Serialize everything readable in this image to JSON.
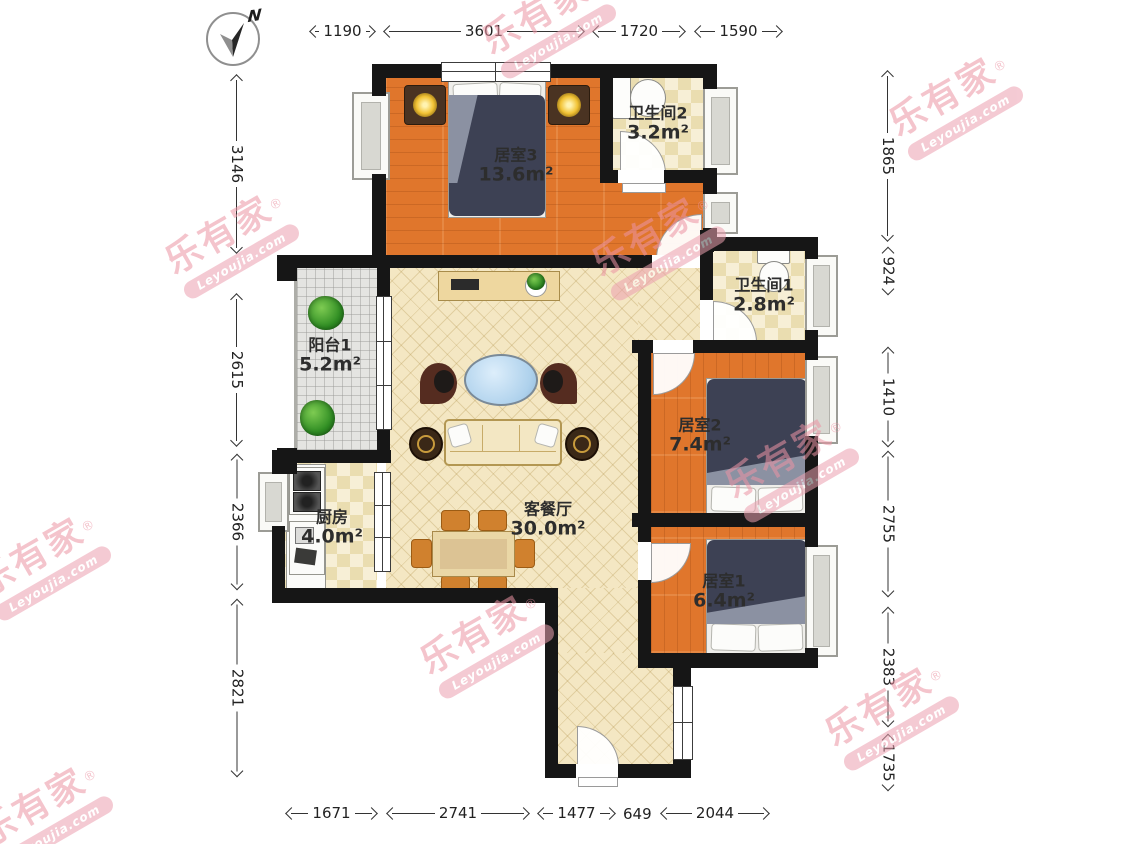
{
  "compass": {
    "north_label": "N"
  },
  "watermark": {
    "brand": "乐有家",
    "registered": "®",
    "domain": "Leyoujia.com"
  },
  "rooms": {
    "bedroom3": {
      "name": "居室3",
      "area": "13.6m²"
    },
    "bath2": {
      "name": "卫生间2",
      "area": "3.2m²"
    },
    "bath1": {
      "name": "卫生间1",
      "area": "2.8m²"
    },
    "bedroom2": {
      "name": "居室2",
      "area": "7.4m²"
    },
    "bedroom1": {
      "name": "居室1",
      "area": "6.4m²"
    },
    "balcony": {
      "name": "阳台1",
      "area": "5.2m²"
    },
    "kitchen": {
      "name": "厨房",
      "area": "4.0m²"
    },
    "living": {
      "name": "客餐厅",
      "area": "30.0m²"
    }
  },
  "dimensions": {
    "top": [
      {
        "value": "1190"
      },
      {
        "value": "3601"
      },
      {
        "value": "1720"
      },
      {
        "value": "1590"
      }
    ],
    "bottom": [
      {
        "value": "1671"
      },
      {
        "value": "2741"
      },
      {
        "value": "1477"
      },
      {
        "value": "649"
      },
      {
        "value": "2044"
      }
    ],
    "left": [
      {
        "value": "3146"
      },
      {
        "value": "2615"
      },
      {
        "value": "2366"
      },
      {
        "value": "2821"
      }
    ],
    "right": [
      {
        "value": "1865"
      },
      {
        "value": "924"
      },
      {
        "value": "1410"
      },
      {
        "value": "2755"
      },
      {
        "value": "2383"
      },
      {
        "value": "1735"
      }
    ]
  },
  "colors": {
    "wall": "#161616",
    "wood": "#e0762c",
    "living_floor": "#f4e7c3",
    "watermark_pink": "#ec94a4"
  }
}
